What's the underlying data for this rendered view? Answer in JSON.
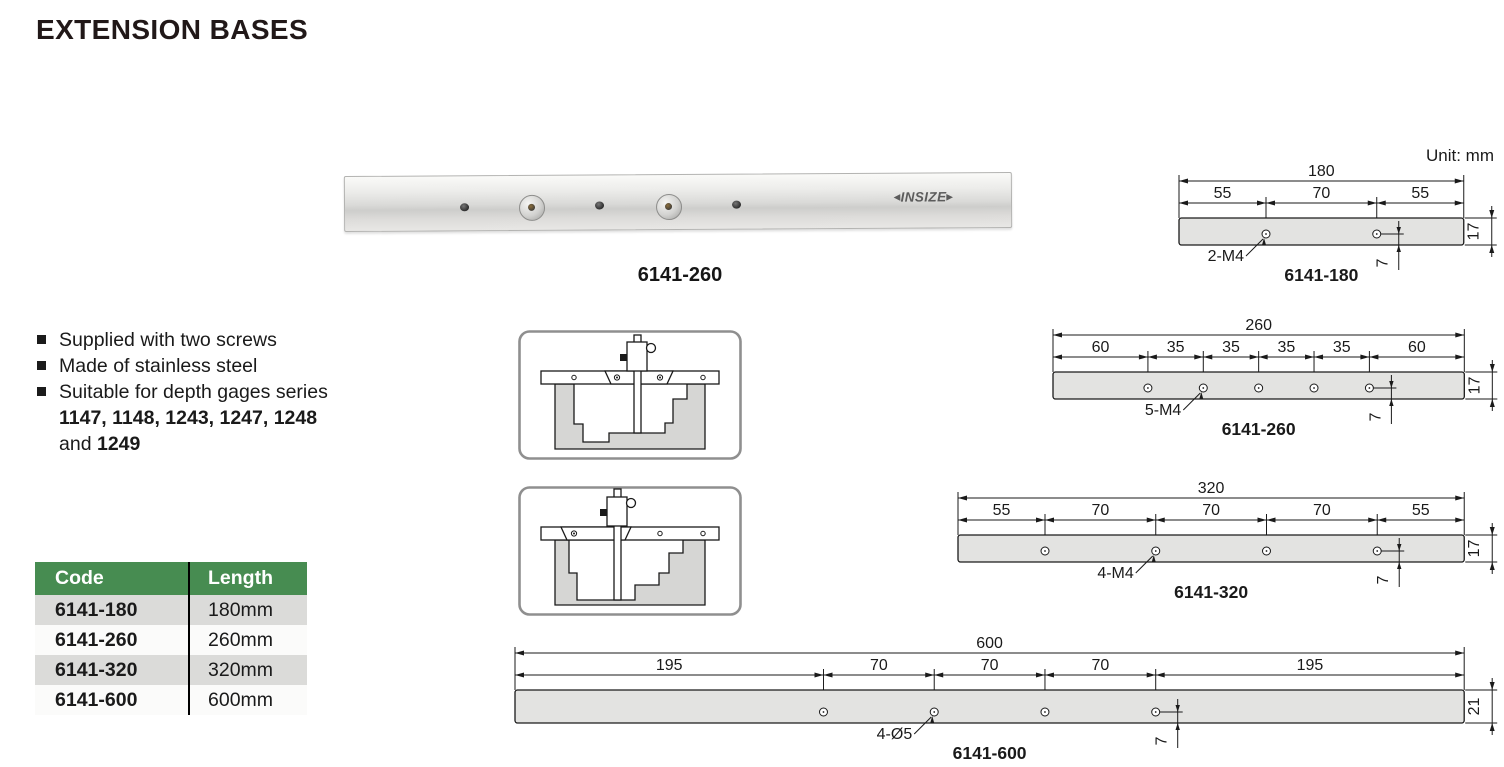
{
  "page": {
    "title": "EXTENSION BASES",
    "unit_label": "Unit: mm"
  },
  "photo": {
    "caption": "6141-260",
    "logo_text": "INSIZE"
  },
  "features": {
    "item1": "Supplied with two screws",
    "item2": "Made of stainless steel",
    "item3_line1": "Suitable for depth gages series",
    "item3_line2": "1147, 1148, 1243, 1247, 1248",
    "item3_line3_normal": "and",
    "item3_line3_bold": "1249"
  },
  "table": {
    "columns": [
      "Code",
      "Length"
    ],
    "rows": [
      [
        "6141-180",
        "180mm"
      ],
      [
        "6141-260",
        "260mm"
      ],
      [
        "6141-320",
        "320mm"
      ],
      [
        "6141-600",
        "600mm"
      ]
    ]
  },
  "drawing_colors": {
    "bar_fill": "#e3e3e1",
    "line": "#1a1a1a"
  },
  "drawings": [
    {
      "name": "6141-180",
      "total_mm": 180,
      "segments_mm": [
        55,
        70,
        55
      ],
      "hole_label": "2-M4",
      "thickness_mm": 17,
      "thickness_label": "17",
      "hole_offset_label": "7",
      "leader_hole_index": 0
    },
    {
      "name": "6141-260",
      "total_mm": 260,
      "segments_mm": [
        60,
        35,
        35,
        35,
        35,
        60
      ],
      "hole_label": "5-M4",
      "thickness_mm": 17,
      "thickness_label": "17",
      "hole_offset_label": "7",
      "leader_hole_index": 1
    },
    {
      "name": "6141-320",
      "total_mm": 320,
      "segments_mm": [
        55,
        70,
        70,
        70,
        55
      ],
      "hole_label": "4-M4",
      "thickness_mm": 17,
      "thickness_label": "17",
      "hole_offset_label": "7",
      "leader_hole_index": 1
    },
    {
      "name": "6141-600",
      "total_mm": 600,
      "segments_mm": [
        195,
        70,
        70,
        70,
        195
      ],
      "hole_label": "4-Ø5",
      "thickness_mm": 21,
      "thickness_label": "21",
      "hole_offset_label": "7",
      "leader_hole_index": 1
    }
  ]
}
